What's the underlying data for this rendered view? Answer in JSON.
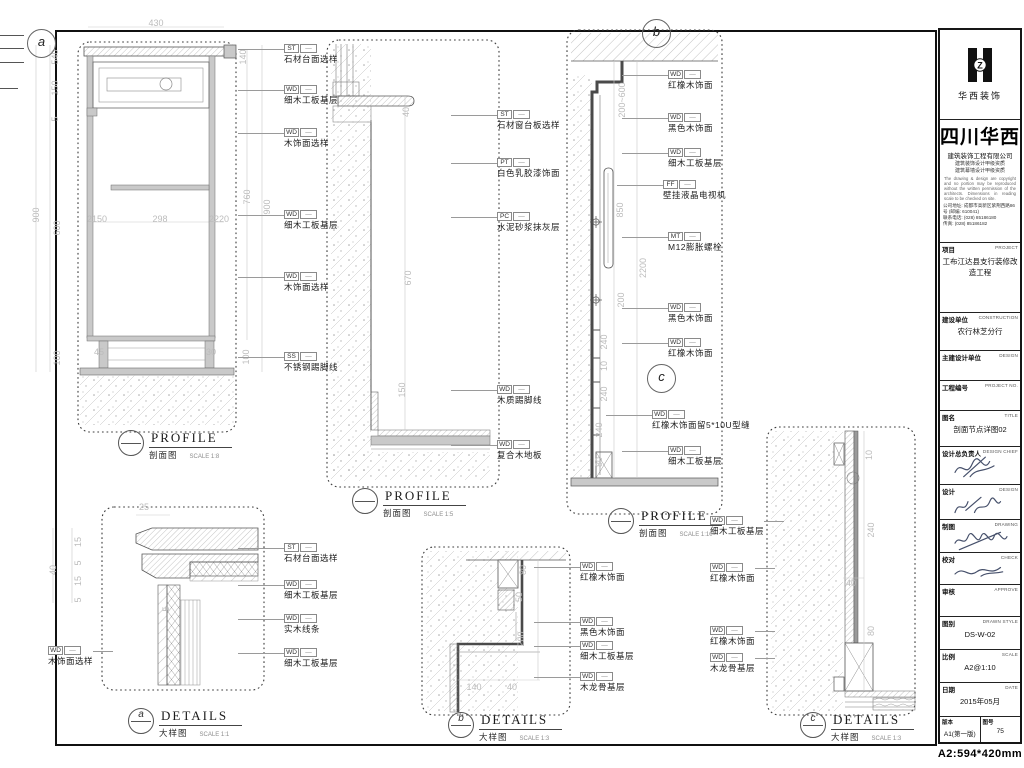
{
  "company": {
    "logo_caption": "华西装饰",
    "name_large": "四川华西",
    "name_sub": "建筑装饰工程有限公司",
    "qual1": "建筑装饰设计甲级资质",
    "qual2": "建筑幕墙设计甲级资质",
    "notice": "The drawing & design are copyright and no portion may be reproduced without the written permission of the architects. Dimensions in reading scale to be checked on site.",
    "contact1": "公司地址: 成都市高新区紫荆西路86号 (邮编: 610041)",
    "contact2": "联系电话: (028) 85186180",
    "contact3": "传真: (028) 85186182"
  },
  "titleblock": {
    "rows": [
      {
        "cn": "项目",
        "en": "PROJECT",
        "value": "工布江达县支行装修改造工程",
        "h": 70
      },
      {
        "cn": "建设单位",
        "en": "CONSTRUCTION",
        "value": "农行林芝分行",
        "h": 38
      },
      {
        "cn": "主建设计单位",
        "en": "DESIGN",
        "value": "",
        "h": 30
      },
      {
        "cn": "工程编号",
        "en": "PROJECT NO.",
        "value": "",
        "h": 30
      },
      {
        "cn": "图名",
        "en": "TITLE",
        "value": "剖面节点详图02",
        "h": 36
      },
      {
        "cn": "设计总负责人",
        "en": "DESIGN CHIEF",
        "value": "",
        "h": 38,
        "sig": 0
      },
      {
        "cn": "设计",
        "en": "DESIGN",
        "value": "",
        "h": 35,
        "sig": 1
      },
      {
        "cn": "制图",
        "en": "DRAWING",
        "value": "",
        "h": 33,
        "sig": 2
      },
      {
        "cn": "校对",
        "en": "CHECK",
        "value": "",
        "h": 32,
        "sig": 3
      },
      {
        "cn": "审核",
        "en": "APPROVE",
        "value": "",
        "h": 32
      },
      {
        "cn": "图别",
        "en": "DRAWN STYLE",
        "value": "DS-W-02",
        "h": 33
      },
      {
        "cn": "比例",
        "en": "SCALE",
        "value": "A2@1:10",
        "h": 33
      },
      {
        "cn": "日期",
        "en": "DATE",
        "value": "2015年05月",
        "h": 33
      }
    ],
    "footer": {
      "left_label": "版本",
      "left_value": "A1(第一版)",
      "right_label": "图号",
      "right_value": "75"
    },
    "paper_note": "A2:594*420mm"
  },
  "annotations": {
    "callouts": [
      {
        "code": "ST",
        "text": "石材台面选样",
        "x": 284,
        "y": 44
      },
      {
        "code": "WD",
        "text": "细木工板基层",
        "x": 284,
        "y": 85
      },
      {
        "code": "WD",
        "text": "木饰面选样",
        "x": 284,
        "y": 128
      },
      {
        "code": "WD",
        "text": "细木工板基层",
        "x": 284,
        "y": 210
      },
      {
        "code": "WD",
        "text": "木饰面选样",
        "x": 284,
        "y": 272
      },
      {
        "code": "SS",
        "text": "不锈钢踢脚线",
        "x": 284,
        "y": 352
      },
      {
        "code": "ST",
        "text": "石材窗台板选样",
        "x": 497,
        "y": 110
      },
      {
        "code": "PT",
        "text": "白色乳胶漆饰面",
        "x": 497,
        "y": 158
      },
      {
        "code": "PC",
        "text": "水泥砂浆抹灰层",
        "x": 497,
        "y": 212
      },
      {
        "code": "WD",
        "text": "木质踢脚线",
        "x": 497,
        "y": 385
      },
      {
        "code": "WD",
        "text": "复合木地板",
        "x": 497,
        "y": 440
      },
      {
        "code": "WD",
        "text": "红橡木饰面",
        "x": 668,
        "y": 70
      },
      {
        "code": "WD",
        "text": "黑色木饰面",
        "x": 668,
        "y": 113
      },
      {
        "code": "WD",
        "text": "细木工板基层",
        "x": 668,
        "y": 148
      },
      {
        "code": "FF",
        "text": "壁挂液晶电视机",
        "x": 663,
        "y": 180
      },
      {
        "code": "MT",
        "text": "M12膨胀螺栓",
        "x": 668,
        "y": 232
      },
      {
        "code": "WD",
        "text": "黑色木饰面",
        "x": 668,
        "y": 303
      },
      {
        "code": "WD",
        "text": "红橡木饰面",
        "x": 668,
        "y": 338
      },
      {
        "code": "WD",
        "text": "红橡木饰面留5*10U型缝",
        "x": 652,
        "y": 410
      },
      {
        "code": "WD",
        "text": "细木工板基层",
        "x": 668,
        "y": 446
      },
      {
        "code": "WD",
        "text": "细木工板基层",
        "x": 710,
        "y": 516,
        "side": "left"
      },
      {
        "code": "WD",
        "text": "红橡木饰面",
        "x": 710,
        "y": 563,
        "side": "left"
      },
      {
        "code": "WD",
        "text": "红橡木饰面",
        "x": 710,
        "y": 626,
        "side": "left"
      },
      {
        "code": "WD",
        "text": "木龙骨基层",
        "x": 710,
        "y": 653,
        "side": "left"
      },
      {
        "code": "ST",
        "text": "石材台面选样",
        "x": 284,
        "y": 543
      },
      {
        "code": "WD",
        "text": "细木工板基层",
        "x": 284,
        "y": 580
      },
      {
        "code": "WD",
        "text": "实木线条",
        "x": 284,
        "y": 614
      },
      {
        "code": "WD",
        "text": "细木工板基层",
        "x": 284,
        "y": 648
      },
      {
        "code": "WD",
        "text": "木饰面选样",
        "x": 48,
        "y": 646,
        "side": "left"
      },
      {
        "code": "WD",
        "text": "红橡木饰面",
        "x": 580,
        "y": 562
      },
      {
        "code": "WD",
        "text": "黑色木饰面",
        "x": 580,
        "y": 617
      },
      {
        "code": "WD",
        "text": "细木工板基层",
        "x": 580,
        "y": 641
      },
      {
        "code": "WD",
        "text": "木龙骨基层",
        "x": 580,
        "y": 672
      }
    ],
    "dims": [
      {
        "t": "430",
        "x": 156,
        "y": 23
      },
      {
        "t": "540",
        "x": 55,
        "y": 57,
        "r": 1
      },
      {
        "t": "150",
        "x": 55,
        "y": 88,
        "r": 1
      },
      {
        "t": "5",
        "x": 55,
        "y": 119,
        "r": 1
      },
      {
        "t": "900",
        "x": 36,
        "y": 215,
        "r": 1
      },
      {
        "t": "600",
        "x": 57,
        "y": 228,
        "r": 1
      },
      {
        "t": "100",
        "x": 57,
        "y": 358,
        "r": 1
      },
      {
        "t": "2150",
        "x": 97,
        "y": 219
      },
      {
        "t": "298",
        "x": 160,
        "y": 219
      },
      {
        "t": "2220",
        "x": 219,
        "y": 219
      },
      {
        "t": "45",
        "x": 99,
        "y": 352
      },
      {
        "t": "30",
        "x": 211,
        "y": 352
      },
      {
        "t": "100",
        "x": 246,
        "y": 357,
        "r": 1
      },
      {
        "t": "140",
        "x": 243,
        "y": 57,
        "r": 1
      },
      {
        "t": "760",
        "x": 247,
        "y": 197,
        "r": 1
      },
      {
        "t": "900",
        "x": 267,
        "y": 207,
        "r": 1
      },
      {
        "t": "40",
        "x": 406,
        "y": 112,
        "r": 1
      },
      {
        "t": "670",
        "x": 408,
        "y": 278,
        "r": 1
      },
      {
        "t": "150",
        "x": 402,
        "y": 390,
        "r": 1
      },
      {
        "t": "200~600",
        "x": 622,
        "y": 100,
        "r": 1
      },
      {
        "t": "850",
        "x": 620,
        "y": 210,
        "r": 1
      },
      {
        "t": "2200",
        "x": 643,
        "y": 268,
        "r": 1
      },
      {
        "t": "200",
        "x": 621,
        "y": 300,
        "r": 1
      },
      {
        "t": "240",
        "x": 604,
        "y": 342,
        "r": 1
      },
      {
        "t": "10",
        "x": 604,
        "y": 366,
        "r": 1
      },
      {
        "t": "240",
        "x": 604,
        "y": 394,
        "r": 1
      },
      {
        "t": "240",
        "x": 599,
        "y": 430,
        "r": 1
      },
      {
        "t": "80",
        "x": 599,
        "y": 462,
        "r": 1
      },
      {
        "t": "10",
        "x": 869,
        "y": 455,
        "r": 1
      },
      {
        "t": "240",
        "x": 871,
        "y": 530,
        "r": 1
      },
      {
        "t": "40",
        "x": 851,
        "y": 583
      },
      {
        "t": "80",
        "x": 871,
        "y": 631,
        "r": 1
      },
      {
        "t": "25",
        "x": 144,
        "y": 507
      },
      {
        "t": "40",
        "x": 53,
        "y": 570,
        "r": 1
      },
      {
        "t": "15",
        "x": 78,
        "y": 542,
        "r": 1
      },
      {
        "t": "5",
        "x": 78,
        "y": 563,
        "r": 1
      },
      {
        "t": "15",
        "x": 78,
        "y": 581,
        "r": 1
      },
      {
        "t": "5",
        "x": 78,
        "y": 600,
        "r": 1
      },
      {
        "t": "5",
        "x": 166,
        "y": 609,
        "r": 1
      },
      {
        "t": "80",
        "x": 523,
        "y": 570,
        "r": 1
      },
      {
        "t": "50",
        "x": 519,
        "y": 597,
        "r": 1
      },
      {
        "t": "200",
        "x": 521,
        "y": 639,
        "r": 1
      },
      {
        "t": "140",
        "x": 474,
        "y": 687
      },
      {
        "t": "40",
        "x": 512,
        "y": 687
      }
    ],
    "titles": [
      {
        "main": "PROFILE",
        "sub": "剖面图",
        "scale": "SCALE 1:8",
        "marker": "",
        "x": 118,
        "y": 430
      },
      {
        "main": "PROFILE",
        "sub": "剖面图",
        "scale": "SCALE 1:5",
        "marker": "",
        "x": 352,
        "y": 488
      },
      {
        "main": "PROFILE",
        "sub": "剖面图",
        "scale": "SCALE 1:10",
        "marker": "",
        "x": 608,
        "y": 508
      },
      {
        "main": "DETAILS",
        "sub": "大样图",
        "scale": "SCALE 1:1",
        "marker": "a",
        "x": 128,
        "y": 708
      },
      {
        "main": "DETAILS",
        "sub": "大样图",
        "scale": "SCALE 1:3",
        "marker": "b",
        "x": 448,
        "y": 712
      },
      {
        "main": "DETAILS",
        "sub": "大样图",
        "scale": "SCALE 1:3",
        "marker": "c",
        "x": 800,
        "y": 712
      }
    ],
    "bubbles": [
      {
        "letter": "a",
        "x": 27,
        "y": 29
      },
      {
        "letter": "b",
        "x": 642,
        "y": 19
      },
      {
        "letter": "c",
        "x": 647,
        "y": 364
      }
    ]
  }
}
